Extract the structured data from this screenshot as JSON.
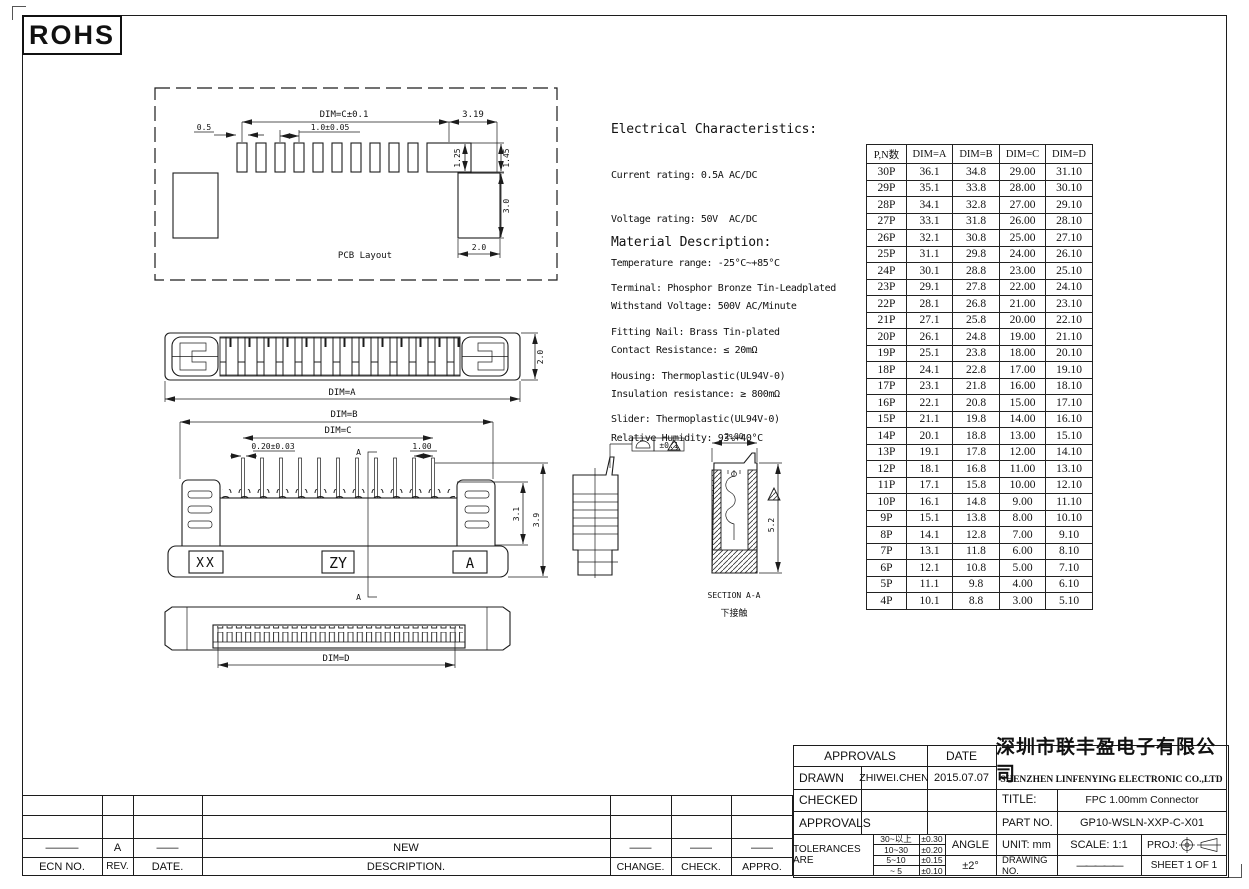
{
  "rohs": "ROHS",
  "electrical": {
    "title": "Electrical Characteristics:",
    "lines": [
      "Current rating: 0.5A AC/DC",
      "Voltage rating: 50V  AC/DC",
      "Temperature range: -25°C~+85°C",
      "Withstand Voltage: 500V AC/Minute",
      "Contact Resistance: ≤ 20mΩ",
      "Insulation resistance: ≥ 800mΩ",
      "Relative Humidity: 93%+40°C"
    ]
  },
  "material": {
    "title": "Material Description:",
    "lines": [
      "Terminal: Phosphor Bronze Tin-Leadplated",
      "Fitting Nail: Brass Tin-plated",
      "Housing: Thermoplastic(UL94V-0)",
      "Slider: Thermoplastic(UL94V-0)"
    ]
  },
  "drawings": {
    "pcb": {
      "caption": "PCB Layout",
      "dim_c": "DIM=C±0.1",
      "d319": "3.19",
      "d05": "0.5",
      "d10": "1.0±0.05",
      "d125": "1.25",
      "d145": "1.45",
      "d30": "3.0",
      "d20": "2.0"
    },
    "top": {
      "dim_a": "DIM=A",
      "d20": "2.0"
    },
    "front": {
      "dim_b": "DIM=B",
      "dim_c": "DIM=C",
      "d020": "0.20±0.03",
      "d100": "1.00",
      "xx": "XX",
      "zy": "ZY",
      "a": "A",
      "d31": "3.1",
      "d39": "3.9",
      "sec": "A"
    },
    "side": {
      "tol": "±0.1"
    },
    "section": {
      "d200": "2.00",
      "d52": "5.2",
      "caption": "SECTION A-A",
      "caption_cn": "下接触"
    },
    "bottom": {
      "dim_d": "DIM=D"
    }
  },
  "dim_table": {
    "headers": [
      "P,N数",
      "DIM=A",
      "DIM=B",
      "DIM=C",
      "DIM=D"
    ],
    "rows": [
      [
        "30P",
        "36.1",
        "34.8",
        "29.00",
        "31.10"
      ],
      [
        "29P",
        "35.1",
        "33.8",
        "28.00",
        "30.10"
      ],
      [
        "28P",
        "34.1",
        "32.8",
        "27.00",
        "29.10"
      ],
      [
        "27P",
        "33.1",
        "31.8",
        "26.00",
        "28.10"
      ],
      [
        "26P",
        "32.1",
        "30.8",
        "25.00",
        "27.10"
      ],
      [
        "25P",
        "31.1",
        "29.8",
        "24.00",
        "26.10"
      ],
      [
        "24P",
        "30.1",
        "28.8",
        "23.00",
        "25.10"
      ],
      [
        "23P",
        "29.1",
        "27.8",
        "22.00",
        "24.10"
      ],
      [
        "22P",
        "28.1",
        "26.8",
        "21.00",
        "23.10"
      ],
      [
        "21P",
        "27.1",
        "25.8",
        "20.00",
        "22.10"
      ],
      [
        "20P",
        "26.1",
        "24.8",
        "19.00",
        "21.10"
      ],
      [
        "19P",
        "25.1",
        "23.8",
        "18.00",
        "20.10"
      ],
      [
        "18P",
        "24.1",
        "22.8",
        "17.00",
        "19.10"
      ],
      [
        "17P",
        "23.1",
        "21.8",
        "16.00",
        "18.10"
      ],
      [
        "16P",
        "22.1",
        "20.8",
        "15.00",
        "17.10"
      ],
      [
        "15P",
        "21.1",
        "19.8",
        "14.00",
        "16.10"
      ],
      [
        "14P",
        "20.1",
        "18.8",
        "13.00",
        "15.10"
      ],
      [
        "13P",
        "19.1",
        "17.8",
        "12.00",
        "14.10"
      ],
      [
        "12P",
        "18.1",
        "16.8",
        "11.00",
        "13.10"
      ],
      [
        "11P",
        "17.1",
        "15.8",
        "10.00",
        "12.10"
      ],
      [
        "10P",
        "16.1",
        "14.8",
        "9.00",
        "11.10"
      ],
      [
        "9P",
        "15.1",
        "13.8",
        "8.00",
        "10.10"
      ],
      [
        "8P",
        "14.1",
        "12.8",
        "7.00",
        "9.10"
      ],
      [
        "7P",
        "13.1",
        "11.8",
        "6.00",
        "8.10"
      ],
      [
        "6P",
        "12.1",
        "10.8",
        "5.00",
        "7.10"
      ],
      [
        "5P",
        "11.1",
        "9.8",
        "4.00",
        "6.10"
      ],
      [
        "4P",
        "10.1",
        "8.8",
        "3.00",
        "5.10"
      ]
    ]
  },
  "revision_table": {
    "headers": [
      "ECN NO.",
      "REV.",
      "DATE.",
      "DESCRIPTION.",
      "CHANGE.",
      "CHECK.",
      "APPRO."
    ],
    "entry": {
      "ecn": "———",
      "rev": "A",
      "date": "——",
      "description": "NEW",
      "change": "——",
      "check": "——",
      "appro": "——"
    }
  },
  "title_block": {
    "approvals_header": "APPROVALS",
    "date_header": "DATE",
    "drawn_label": "DRAWN",
    "drawn_name": "ZHIWEI.CHEN",
    "drawn_date": "2015.07.07",
    "checked_label": "CHECKED",
    "approvals_label": "APPROVALS",
    "tolerances_label": "TOLERANCES ARE",
    "tolerances": {
      "r0": [
        "30~以上",
        "±0.30"
      ],
      "r1": [
        "10~30",
        "±0.20"
      ],
      "r2": [
        "5~10",
        "±0.15"
      ],
      "r3": [
        "~ 5",
        "±0.10"
      ]
    },
    "angle_label": "ANGLE",
    "angle_value": "±2°",
    "company_cn": "深圳市联丰盈电子有限公司",
    "company_en": "SHENZHEN LINFENYING ELECTRONIC CO.,LTD",
    "title_label": "TITLE:",
    "title_value": "FPC 1.00mm  Connector",
    "part_label": "PART NO.",
    "part_value": "GP10-WSLN-XXP-C-X01",
    "unit_label": "UNIT: mm",
    "scale_label": "SCALE:  1:1",
    "proj_label": "PROJ:",
    "drawing_no_label": "DRAWING NO.",
    "drawing_no_value": "—————",
    "sheet_label": "SHEET  1 OF 1"
  }
}
